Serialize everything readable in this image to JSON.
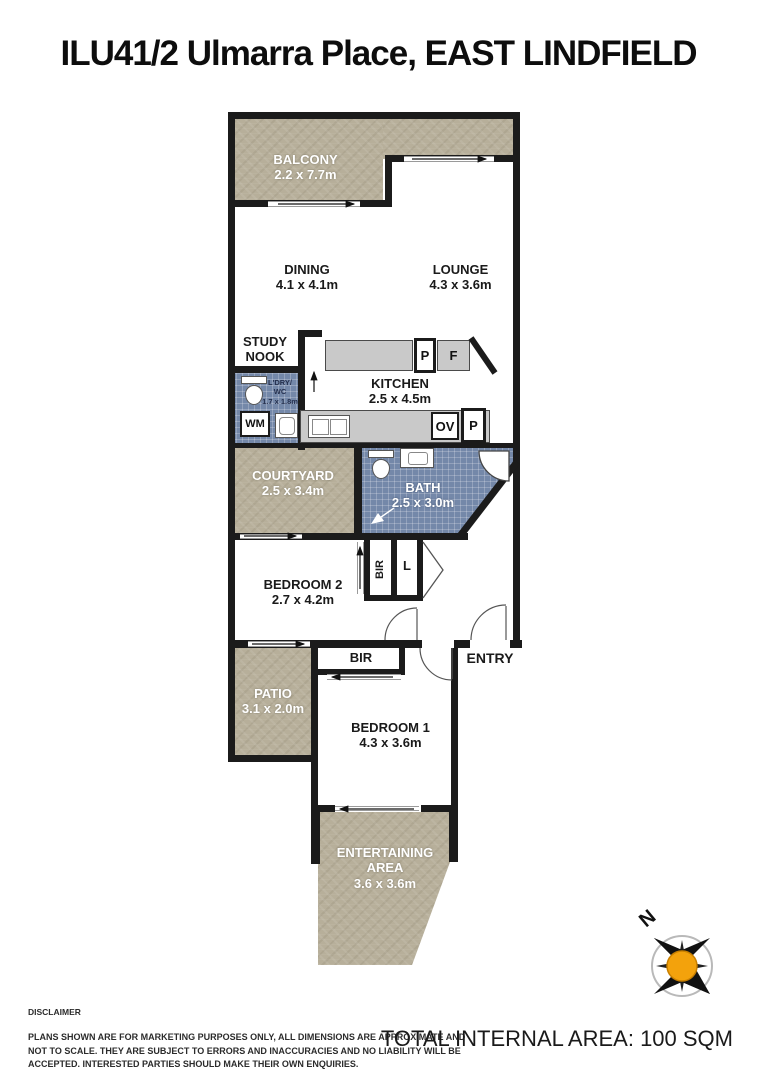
{
  "title": "ILU41/2 Ulmarra Place, EAST LINDFIELD",
  "plan": {
    "rooms": {
      "balcony": {
        "name": "BALCONY",
        "dims": "2.2 x 7.7m"
      },
      "dining": {
        "name": "DINING",
        "dims": "4.1 x 4.1m"
      },
      "lounge": {
        "name": "LOUNGE",
        "dims": "4.3 x 3.6m"
      },
      "study_nook": {
        "line1": "STUDY",
        "line2": "NOOK"
      },
      "kitchen": {
        "name": "KITCHEN",
        "dims": "2.5 x 4.5m"
      },
      "laundry_wc": {
        "line1": "L'DRY/",
        "line2": "WC",
        "dims": "1.7 x 1.8m"
      },
      "courtyard": {
        "name": "COURTYARD",
        "dims": "2.5 x 3.4m"
      },
      "bath": {
        "name": "BATH",
        "dims": "2.5 x 3.0m"
      },
      "bedroom2": {
        "name": "BEDROOM 2",
        "dims": "2.7 x 4.2m"
      },
      "entry": {
        "name": "ENTRY"
      },
      "patio": {
        "name": "PATIO",
        "dims": "3.1 x 2.0m"
      },
      "bedroom1": {
        "name": "BEDROOM 1",
        "dims": "4.3 x 3.6m"
      },
      "entertaining": {
        "line1": "ENTERTAINING",
        "line2": "AREA",
        "dims": "3.6 x 3.6m"
      }
    },
    "fixtures": {
      "washing_machine": "WM",
      "pantry_top": "P",
      "fridge": "F",
      "oven": "OV",
      "pantry_bottom": "P",
      "bir_bed2": "BIR",
      "linen": "L",
      "bir_bed1": "BIR"
    }
  },
  "compass": {
    "north": "N",
    "center_color": "#F3A20C"
  },
  "footer": {
    "disclaimer_heading": "DISCLAIMER",
    "disclaimer_body": "PLANS SHOWN ARE FOR MARKETING PURPOSES ONLY, ALL DIMENSIONS ARE APPROXIMATE AND NOT TO SCALE. THEY ARE SUBJECT TO ERRORS AND INACCURACIES AND NO LIABILITY WILL BE ACCEPTED. INTERESTED PARTIES SHOULD MAKE THEIR OWN ENQUIRIES.",
    "total_area": "TOTAL INTERNAL AREA: 100 SQM"
  },
  "colors": {
    "outdoor": "#b7af9a",
    "tile": "#7488a9",
    "wall": "#1b1b1b",
    "bench": "#c9c9c9"
  }
}
